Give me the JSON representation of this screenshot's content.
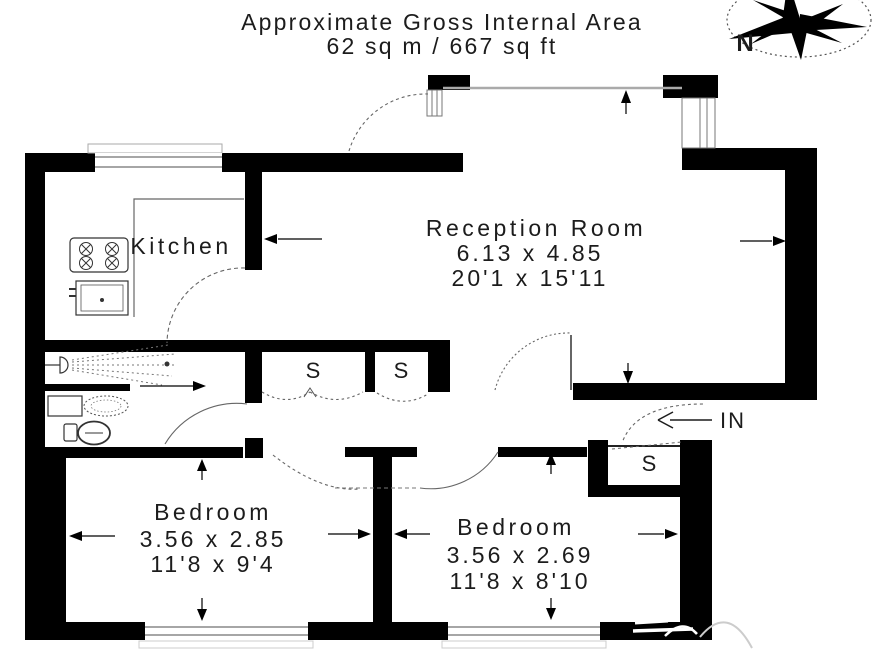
{
  "title": {
    "line1": "Approximate Gross Internal Area",
    "line2": "62 sq m / 667 sq ft"
  },
  "compass": {
    "label": "N"
  },
  "rooms": {
    "kitchen": {
      "label": "Kitchen"
    },
    "reception": {
      "label": "Reception Room",
      "metric": "6.13 x 4.85",
      "imperial": "20'1 x 15'11"
    },
    "bedroom_left": {
      "label": "Bedroom",
      "metric": "3.56 x 2.85",
      "imperial": "11'8 x 9'4"
    },
    "bedroom_right": {
      "label": "Bedroom",
      "metric": "3.56 x 2.69",
      "imperial": "11'8 x 8'10"
    }
  },
  "storage": {
    "label": "S"
  },
  "entrance": {
    "label": "IN"
  },
  "colors": {
    "wall": "#000000",
    "background": "#ffffff",
    "annotation": "#1c1c1c"
  }
}
